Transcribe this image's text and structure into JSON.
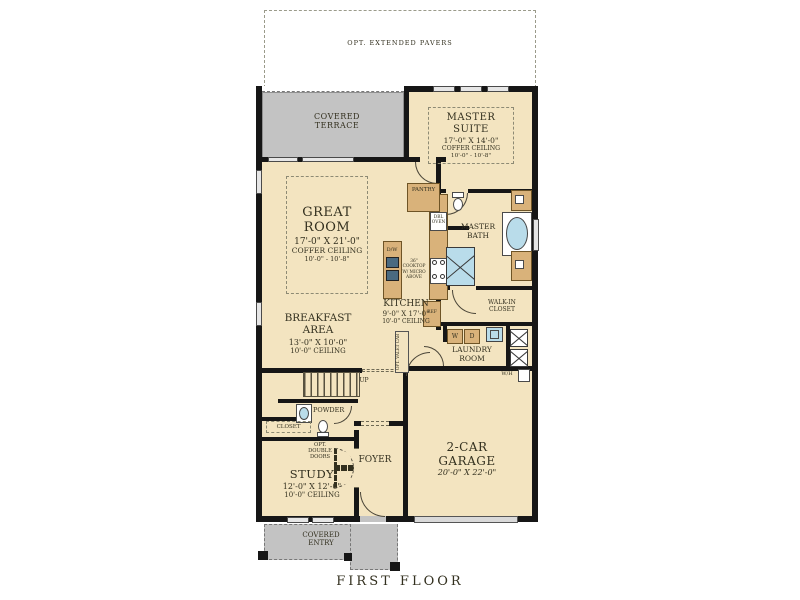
{
  "title": "FIRST FLOOR",
  "colors": {
    "room_fill": "#f3e4c0",
    "covered_fill": "#c3c3c3",
    "wall": "#161616",
    "cabinet": "#d9b27a",
    "fixture_blue": "#b9dcea"
  },
  "outdoor": {
    "pavers_label": "OPT. EXTENDED PAVERS",
    "covered_terrace": "COVERED TERRACE",
    "covered_entry": "COVERED ENTRY"
  },
  "rooms": {
    "master_suite": {
      "name": "MASTER SUITE",
      "dims": "17'-0\" X 14'-0\"",
      "ceiling": "COFFER CEILING",
      "ceiling_height": "10'-0\" - 10'-8\""
    },
    "great_room": {
      "name": "GREAT ROOM",
      "dims": "17'-0\" X 21'-0\"",
      "ceiling": "COFFER CEILING",
      "ceiling_height": "10'-0\" - 10'-8\""
    },
    "master_bath": {
      "name": "MASTER BATH"
    },
    "walk_in_closet": {
      "name": "WALK-IN CLOSET"
    },
    "kitchen": {
      "name": "KITCHEN",
      "dims": "9'-0\" X 17'-0\"",
      "ceiling": "10'-0\" CEILING"
    },
    "breakfast_area": {
      "name": "BREAKFAST AREA",
      "dims": "13'-0\" X 10'-0\"",
      "ceiling": "10'-0\" CEILING"
    },
    "laundry_room": {
      "name": "LAUNDRY ROOM"
    },
    "garage": {
      "name": "2-CAR GARAGE",
      "dims": "20'-0\" X 22'-0\""
    },
    "study": {
      "name": "STUDY",
      "dims": "12'-0\" X 12'-0\"",
      "ceiling": "10'-0\" CEILING"
    },
    "foyer": {
      "name": "FOYER"
    },
    "powder": {
      "name": "POWDER"
    },
    "closet": {
      "name": "CLOSET"
    }
  },
  "annotations": {
    "pantry": "PANTRY",
    "dbl_oven": "DBL OVEN",
    "dishwasher": "D/W",
    "cooktop_note": "36\" COOKTOP W/ MICRO ABOVE",
    "refrigerator": "REF",
    "opt_valet": "OPT. VALET CAB",
    "up": "UP",
    "opt_double_doors": "OPT. DOUBLE DOORS",
    "washer": "W",
    "dryer": "D",
    "water_heater": "W/H"
  }
}
